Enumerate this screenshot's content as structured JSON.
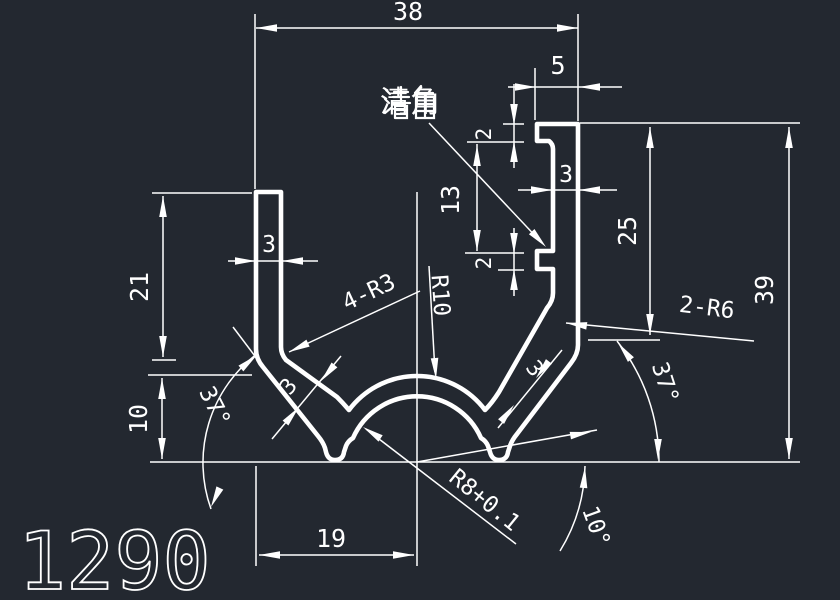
{
  "app": {
    "background_color": "#232830",
    "line_color": "#ffffff"
  },
  "drawing": {
    "part_number": "1290",
    "corner_note": "清角",
    "linear_dimensions": {
      "overall_width": "38",
      "lip_width": "5",
      "lip_thickness": "2",
      "notch_spacing": "13",
      "notch_height": "2",
      "right_wall_thickness": "3",
      "right_wall_height": "25",
      "overall_height": "39",
      "left_wall_height": "21",
      "left_wall_thickness": "3",
      "left_lower_height": "10",
      "base_half_width": "19",
      "left_slant_thickness": "3",
      "right_slant_thickness": "3"
    },
    "radial_labels": {
      "inner_fillets": "4-R3",
      "hump_outer_radius": "R10",
      "bend_radii": "2-R6",
      "hump_inner_radius": "R8+0.1"
    },
    "angular_dimensions": {
      "left_wall_angle": "37°",
      "right_wall_angle": "37°",
      "base_angle": "10°"
    }
  }
}
